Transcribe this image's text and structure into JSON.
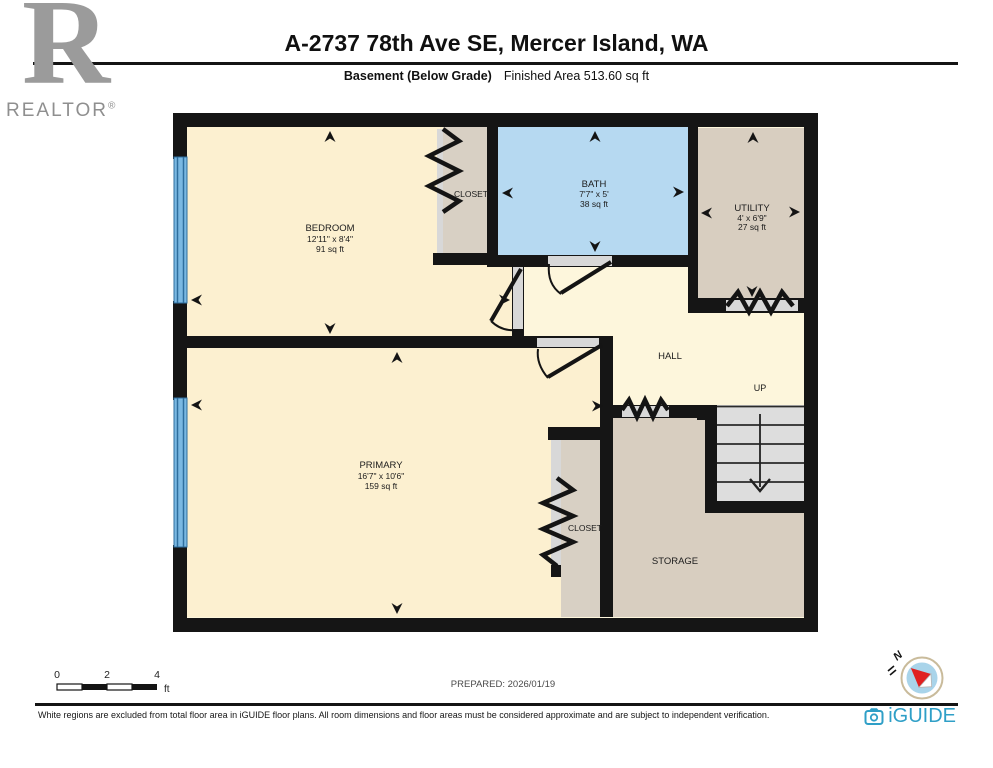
{
  "header": {
    "title": "A-2737 78th Ave SE, Mercer Island, WA",
    "floor_label": "Basement (Below Grade)",
    "area_label": "Finished Area 513.60 sq ft",
    "logo_r": "R",
    "realtor_text": "REALTOR",
    "registered": "®"
  },
  "rooms": {
    "bedroom": {
      "name": "BEDROOM",
      "dims": "12'11\" x 8'4\"",
      "area": "91 sq ft"
    },
    "bedroom_closet": {
      "name": "CLOSET"
    },
    "bath": {
      "name": "BATH",
      "dims": "7'7\" x 5'",
      "area": "38 sq ft"
    },
    "utility": {
      "name": "UTILITY",
      "dims": "4' x 6'9\"",
      "area": "27 sq ft"
    },
    "hall": {
      "name": "HALL"
    },
    "stairs": {
      "label": "UP"
    },
    "primary": {
      "name": "PRIMARY",
      "dims": "16'7\" x 10'6\"",
      "area": "159 sq ft"
    },
    "primary_closet": {
      "name": "CLOSET"
    },
    "storage": {
      "name": "STORAGE"
    }
  },
  "scale_bar": {
    "tick0": "0",
    "tick2": "2",
    "tick4": "4",
    "unit": "ft"
  },
  "prepared": "PREPARED: 2026/01/19",
  "compass": {
    "north_label": "N"
  },
  "footer": {
    "disclaimer": "White regions are excluded from total floor area in iGUIDE floor plans. All room dimensions and floor areas must be considered approximate and are subject to independent verification.",
    "brand": "iGUIDE"
  },
  "colors": {
    "room_cream": "#fcf0d0",
    "hall_yellow": "#fdf6dc",
    "bath_blue": "#b6d9f1",
    "tan": "#d8cec0",
    "closet_tan": "#d8d0c4",
    "stairs_gray": "#dddddd",
    "opening_gray": "#d8d8d8",
    "wall_black": "#151515",
    "window_blue": "#7ab8e2",
    "brand_blue": "#2f9fc7",
    "compass_red": "#e02020"
  }
}
